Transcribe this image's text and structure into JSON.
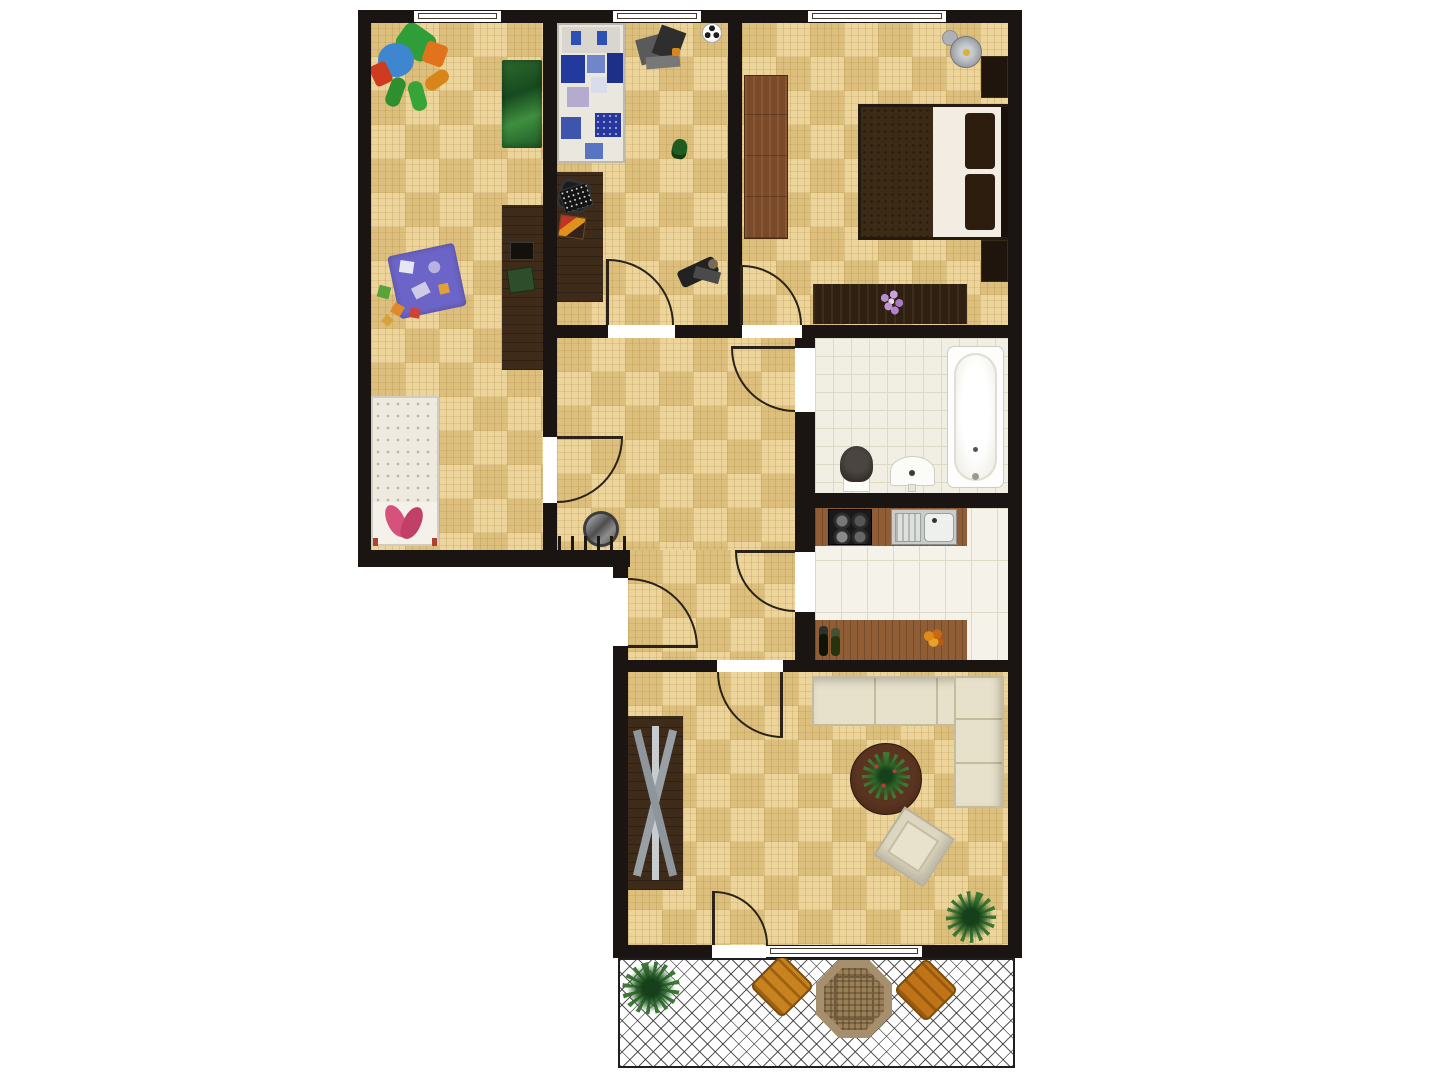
{
  "plan": {
    "type": "apartment-floor-plan",
    "rooms_count": 8,
    "windows_count": 4,
    "doors_count": 8
  },
  "palette": {
    "wall": "#1a1512",
    "floor_parquet": "#e9cd89",
    "bath_tile": "#f1efe3",
    "kitchen_tile": "#f4f2e9",
    "tile_line": "#dcd9c7",
    "wood": "#8f5d36",
    "dark_furniture": "#3f2b1a",
    "sofa": "#e7e1cb",
    "mat_blue": "#6c64c6",
    "rug_green": "#2e6b2e",
    "quilt_blue": "#223a9e",
    "blanket_brown": "#3b2a15",
    "pink": "#d6527c",
    "patio_chair": "#c8821e",
    "plant_green": "#3c7a33",
    "lamp_gray": "#9aa0a6"
  },
  "rooms": [
    {
      "id": "children-room",
      "label": "children room",
      "furniture": [
        "plush-elephant-toy",
        "jungle-rug",
        "toy-shelf",
        "play-mat",
        "toy-blocks",
        "kids-bed"
      ]
    },
    {
      "id": "kids-bedroom",
      "label": "kids bedroom",
      "furniture": [
        "single-bed",
        "desk",
        "desk-chair",
        "laptop",
        "magazine",
        "crane-toy",
        "soccer-ball",
        "plant-toy",
        "motorbike-toy"
      ]
    },
    {
      "id": "master-bedroom",
      "label": "master bedroom",
      "furniture": [
        "wardrobe",
        "floor-lamp",
        "double-bed",
        "nightstand",
        "nightstand",
        "dresser-with-flowers"
      ]
    },
    {
      "id": "hallway",
      "label": "hallway",
      "furniture": [
        "wall-mirror",
        "coat-rack"
      ]
    },
    {
      "id": "bathroom",
      "label": "bathroom",
      "furniture": [
        "bathtub",
        "toilet",
        "wash-basin"
      ]
    },
    {
      "id": "kitchen",
      "label": "kitchen",
      "furniture": [
        "counter-with-cooktop-and-sink",
        "counter-with-bottles",
        "fruit-bowl"
      ]
    },
    {
      "id": "living-room",
      "label": "living room",
      "furniture": [
        "tv-sideboard",
        "corner-sofa",
        "round-coffee-table",
        "table-plant",
        "armchair",
        "potted-plant"
      ]
    },
    {
      "id": "balcony",
      "label": "balcony",
      "furniture": [
        "potted-plant",
        "patio-chair",
        "octagonal-patio-table",
        "patio-chair"
      ]
    }
  ]
}
